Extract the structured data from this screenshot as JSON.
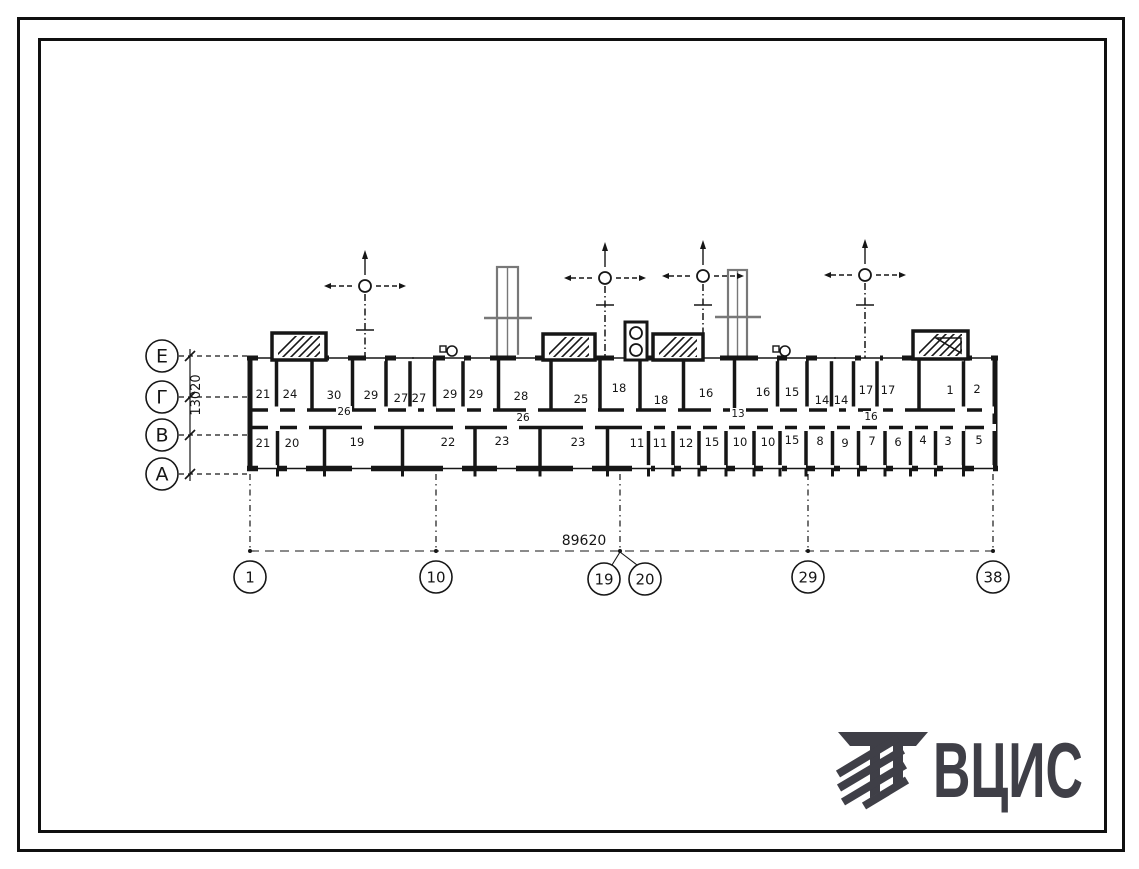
{
  "plan": {
    "row_axes": [
      {
        "label": "Е",
        "y": 356
      },
      {
        "label": "Г",
        "y": 397
      },
      {
        "label": "В",
        "y": 435
      },
      {
        "label": "А",
        "y": 474
      }
    ],
    "col_axes": [
      {
        "label": "1",
        "cx": 250,
        "cy": 577,
        "tx": 250
      },
      {
        "label": "10",
        "cx": 436,
        "cy": 577,
        "tx": 436
      },
      {
        "label": "19",
        "cx": 604,
        "cy": 579,
        "tx": 620
      },
      {
        "label": "20",
        "cx": 645,
        "cy": 579,
        "tx": 620
      },
      {
        "label": "29",
        "cx": 808,
        "cy": 577,
        "tx": 808
      },
      {
        "label": "38",
        "cx": 993,
        "cy": 577,
        "tx": 993
      }
    ],
    "length_dimension": "89620",
    "depth_dimension": "13020",
    "upper_rooms": [
      {
        "n": "21",
        "x": 263,
        "y": 394
      },
      {
        "n": "24",
        "x": 290,
        "y": 394
      },
      {
        "n": "30",
        "x": 334,
        "y": 395
      },
      {
        "n": "29",
        "x": 371,
        "y": 395
      },
      {
        "n": "27",
        "x": 401,
        "y": 398
      },
      {
        "n": "27",
        "x": 419,
        "y": 398
      },
      {
        "n": "29",
        "x": 450,
        "y": 394
      },
      {
        "n": "29",
        "x": 476,
        "y": 394
      },
      {
        "n": "28",
        "x": 521,
        "y": 396
      },
      {
        "n": "25",
        "x": 581,
        "y": 399
      },
      {
        "n": "18",
        "x": 619,
        "y": 388
      },
      {
        "n": "18",
        "x": 661,
        "y": 400
      },
      {
        "n": "16",
        "x": 706,
        "y": 393
      },
      {
        "n": "16",
        "x": 763,
        "y": 392
      },
      {
        "n": "15",
        "x": 792,
        "y": 392
      },
      {
        "n": "14",
        "x": 822,
        "y": 400
      },
      {
        "n": "14",
        "x": 841,
        "y": 400
      },
      {
        "n": "17",
        "x": 866,
        "y": 390
      },
      {
        "n": "17",
        "x": 888,
        "y": 390
      },
      {
        "n": "1",
        "x": 950,
        "y": 390
      },
      {
        "n": "2",
        "x": 977,
        "y": 389
      }
    ],
    "lower_rooms": [
      {
        "n": "21",
        "x": 263,
        "y": 443
      },
      {
        "n": "20",
        "x": 292,
        "y": 443
      },
      {
        "n": "19",
        "x": 357,
        "y": 442
      },
      {
        "n": "22",
        "x": 448,
        "y": 442
      },
      {
        "n": "23",
        "x": 502,
        "y": 441
      },
      {
        "n": "23",
        "x": 578,
        "y": 442
      },
      {
        "n": "11",
        "x": 637,
        "y": 443
      },
      {
        "n": "11",
        "x": 660,
        "y": 443
      },
      {
        "n": "12",
        "x": 686,
        "y": 443
      },
      {
        "n": "15",
        "x": 712,
        "y": 442
      },
      {
        "n": "10",
        "x": 740,
        "y": 442
      },
      {
        "n": "10",
        "x": 768,
        "y": 442
      },
      {
        "n": "15",
        "x": 792,
        "y": 440
      },
      {
        "n": "8",
        "x": 820,
        "y": 441
      },
      {
        "n": "9",
        "x": 845,
        "y": 443
      },
      {
        "n": "7",
        "x": 872,
        "y": 441
      },
      {
        "n": "6",
        "x": 898,
        "y": 442
      },
      {
        "n": "4",
        "x": 923,
        "y": 440
      },
      {
        "n": "3",
        "x": 948,
        "y": 441
      },
      {
        "n": "5",
        "x": 979,
        "y": 440
      }
    ],
    "mid_labels": [
      {
        "n": "26",
        "x": 344,
        "y": 414
      },
      {
        "n": "26",
        "x": 523,
        "y": 420
      },
      {
        "n": "13",
        "x": 738,
        "y": 416
      },
      {
        "n": "16",
        "x": 871,
        "y": 419
      }
    ]
  },
  "logo": {
    "text": "ВЦИС"
  },
  "colors": {
    "ink": "#161616",
    "scan_gray": "#787878",
    "logo": "#3f3f47",
    "paper": "#ffffff"
  }
}
